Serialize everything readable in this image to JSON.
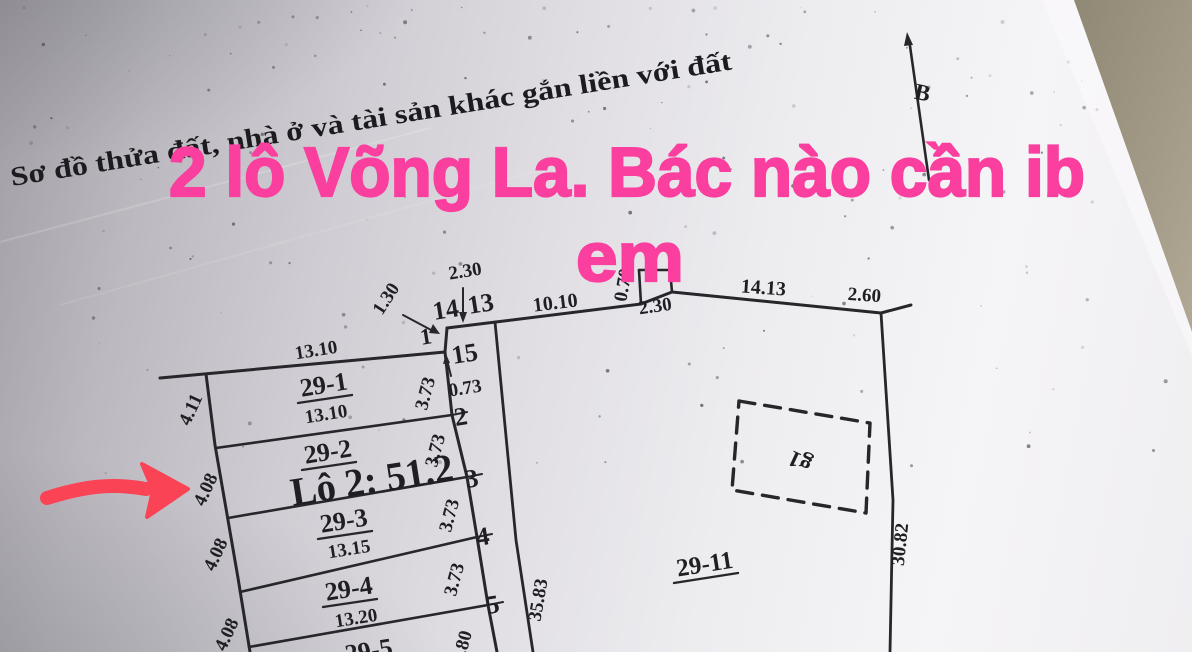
{
  "photo": {
    "header_title": "Sơ đồ thửa đất, nhà ở và tài sản khác gắn liền với đất",
    "overlay_line1": "2 lô Võng La.  Bác nào cần ib",
    "overlay_line2": "em",
    "overlay_color": "#fa3f9f",
    "annotation_arrow_color": "#fa4355",
    "ink_color": "#26262b",
    "paper_edge_color": "#9b947f"
  },
  "compass": {
    "north": "B"
  },
  "parcels": {
    "p29_1": "29-1",
    "p29_2": "29-2",
    "p29_3": "29-3",
    "p29_4": "29-4",
    "p29_5": "29-5",
    "p29_11": "29-11",
    "lot2_note": "Lô 2: 51.2",
    "structure_g1": "g1"
  },
  "vertices": {
    "v1": "1",
    "v2": "2",
    "v3": "3",
    "v4": "4",
    "v5": "5",
    "v13": "13",
    "v14": "14",
    "v15": "15"
  },
  "dims": {
    "row1_top": "13.10",
    "row1_bottom": "13.10",
    "row3_bottom": "13.15",
    "row4_bottom": "13.20",
    "left_29_1": "4.11",
    "left_29_2": "4.08",
    "left_29_3": "4.08",
    "left_29_4": "4.08",
    "right_29_1": "3.73",
    "right_29_2": "3.73",
    "right_29_3": "3.73",
    "right_29_4": "3.73",
    "seg_15_2": "0.73",
    "seg_1_14": "1.30",
    "seg_14_13": "2.30",
    "seg_13_notch": "10.10",
    "notch_up": "0.70",
    "notch_across": "2.30",
    "top_long": "14.13",
    "top_right_ext": "2.60",
    "right_side": "30.82",
    "inner_long": "35.83",
    "bottom_partial": ".80"
  }
}
